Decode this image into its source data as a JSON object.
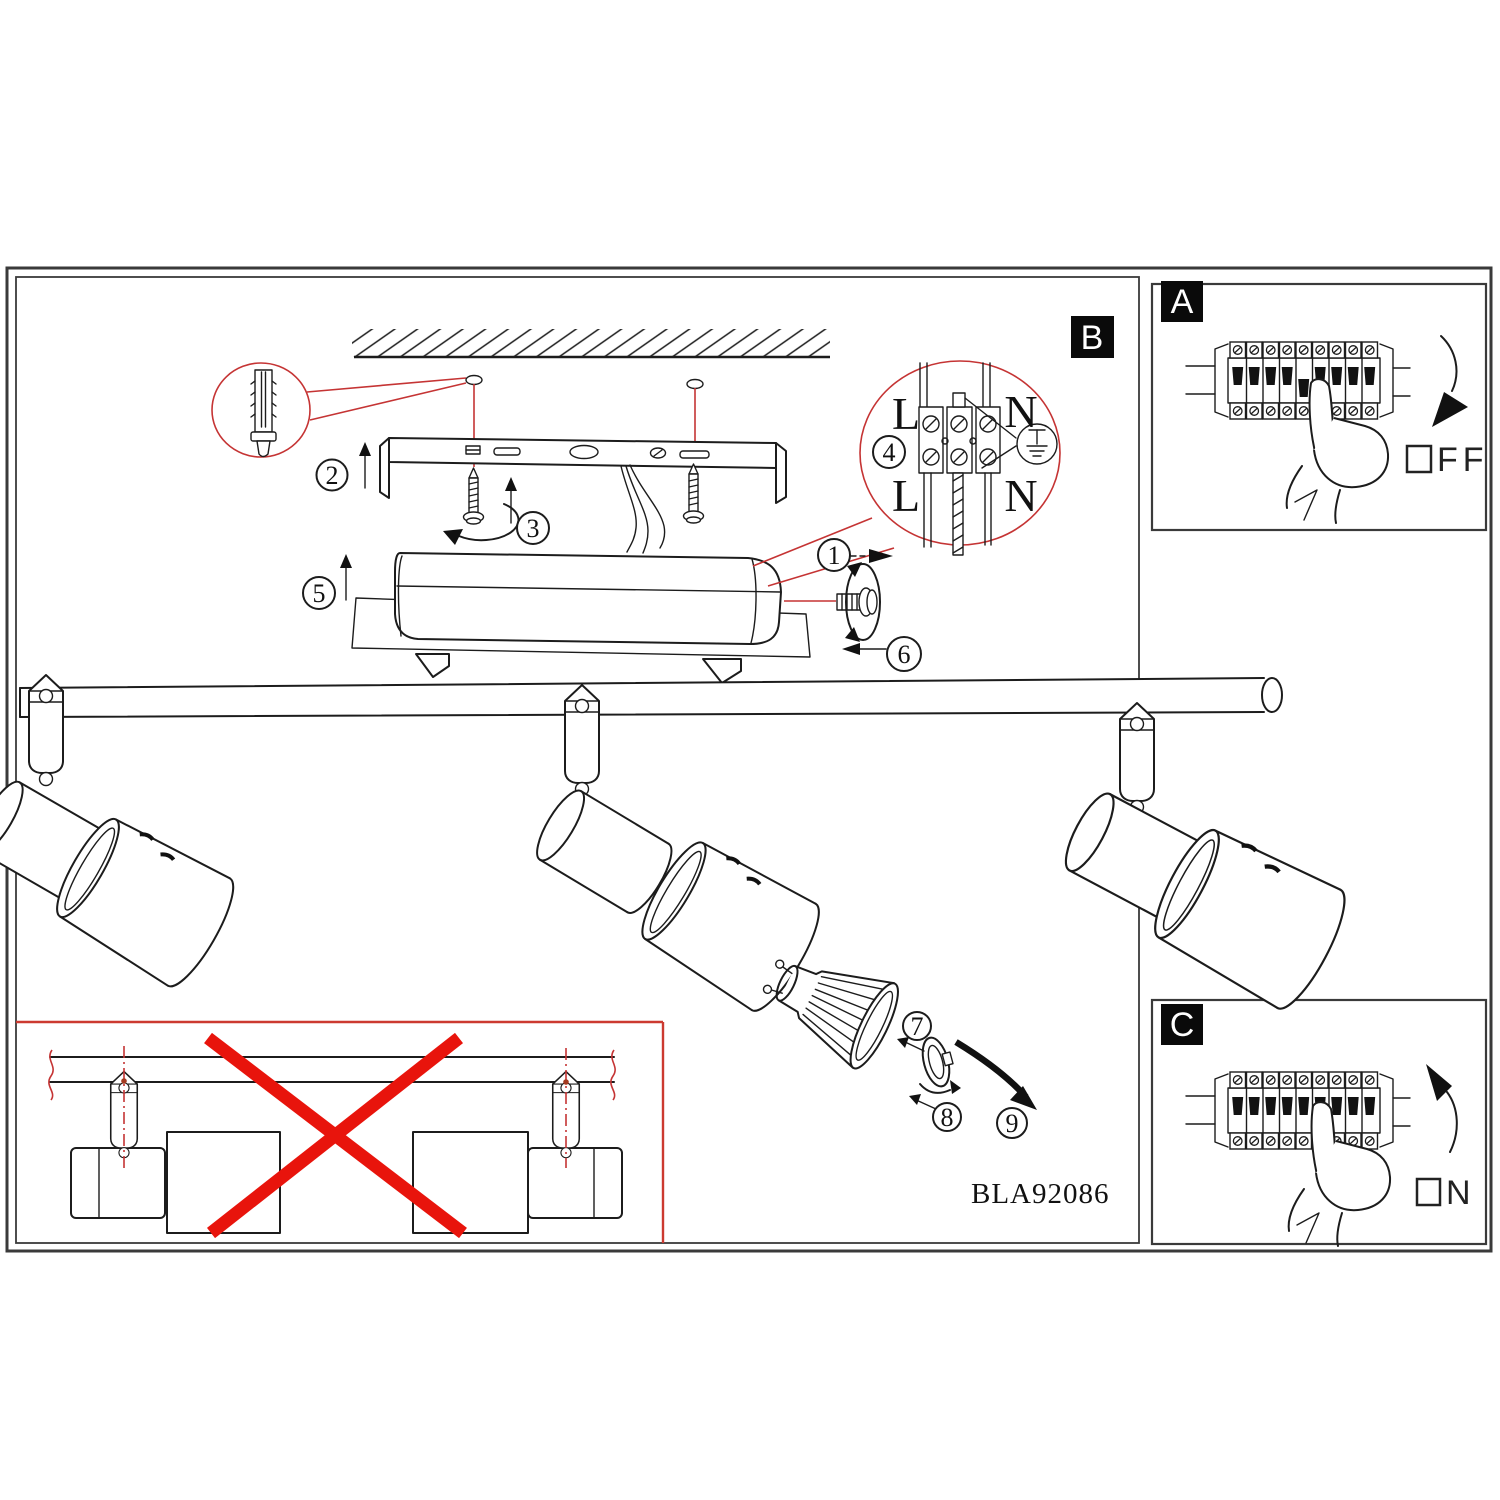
{
  "diagram": {
    "model_code": "BLA92086",
    "section_b_label": "B",
    "panel_a": {
      "label": "A",
      "power_word_suffix": "FF"
    },
    "panel_c": {
      "label": "C",
      "power_word_suffix": "N"
    },
    "wiring_detail": {
      "terminal_top_left": "L",
      "terminal_top_right": "N",
      "terminal_bottom_left": "L",
      "terminal_bottom_right": "N"
    },
    "steps": {
      "s1": "1",
      "s2": "2",
      "s3": "3",
      "s4": "4",
      "s5": "5",
      "s6": "6",
      "s7": "7",
      "s8": "8",
      "s9": "9"
    },
    "colors": {
      "cross_red": "#e8140c",
      "leader_red": "#c53434",
      "ink": "#1c1c1c"
    }
  }
}
